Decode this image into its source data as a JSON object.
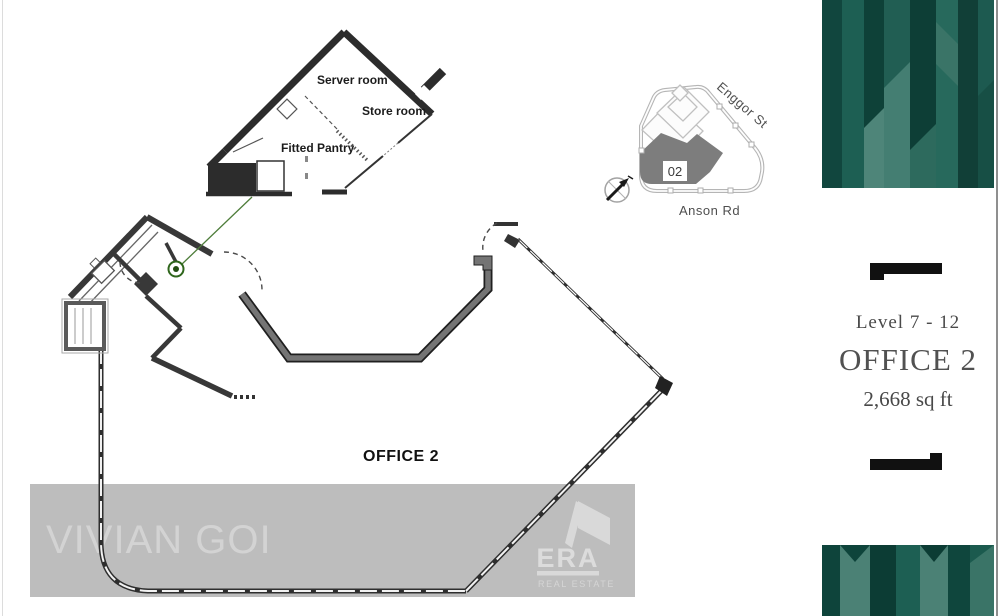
{
  "listing": {
    "level": "Level 7 - 12",
    "unit_name": "OFFICE 2",
    "area": "2,668 sq ft"
  },
  "floor_plan": {
    "office_label": "OFFICE 2",
    "inset": {
      "server_room": "Server room",
      "store_room": "Store room",
      "fitted_pantry": "Fitted Pantry"
    }
  },
  "site_map": {
    "unit_marker": "02",
    "street_upper": "Enggor St",
    "street_lower": "Anson Rd"
  },
  "watermark": {
    "name": "VIVIAN GOI"
  },
  "brand": {
    "name": "ERA",
    "tagline": "REAL ESTATE"
  },
  "colors": {
    "teal_dark": "#0e4138",
    "teal_mid": "#1d5a50",
    "teal_light": "#4e8579",
    "watermark_band": "#bdbdbd",
    "watermark_text": "#d3d3d3",
    "wall_dark": "#333333",
    "corridor_gray": "#747474",
    "map_unit_gray": "#7d7d7d",
    "accent_green": "#2f661c",
    "sidebar_text": "#4a4a4a"
  }
}
